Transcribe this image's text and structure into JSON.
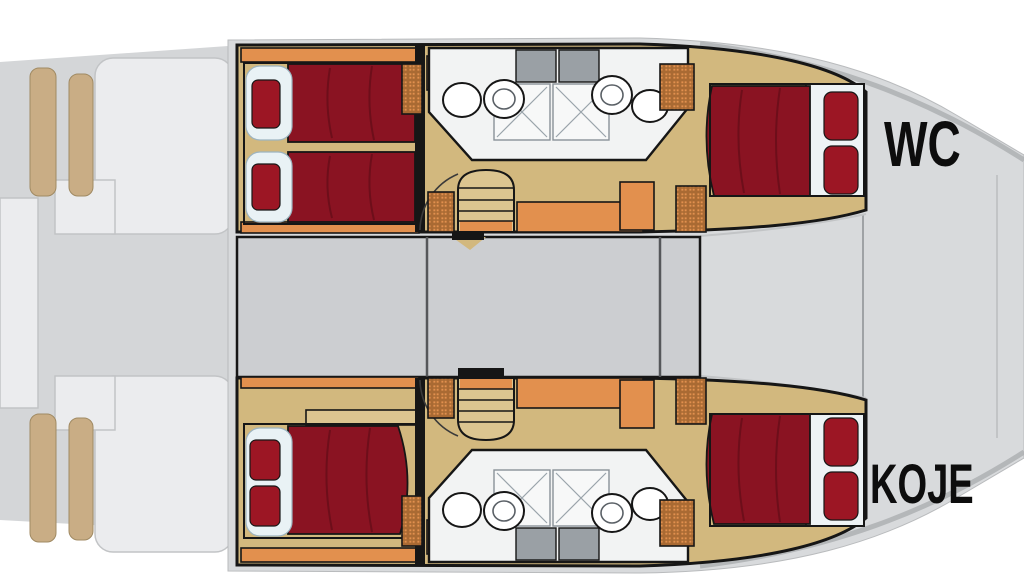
{
  "labels": {
    "wc": "WC",
    "koje": "KOJE"
  },
  "palette": {
    "ink": "#161616",
    "wood": "#d2b87e",
    "wood_light": "#dcc590",
    "orange": "#e2904e",
    "bed_red": "#8a1322",
    "pillow": "#e9f2f5",
    "pillow_red": "#9c1624",
    "salon_gray": "#ccced1",
    "deck_gray": "#d8dadc",
    "platform_white": "#ebecee",
    "stern_gray": "#d4d6d8",
    "fixture_gray": "#9aa0a5",
    "label_ink": "#0d0d0d",
    "bg": "#ffffff"
  }
}
